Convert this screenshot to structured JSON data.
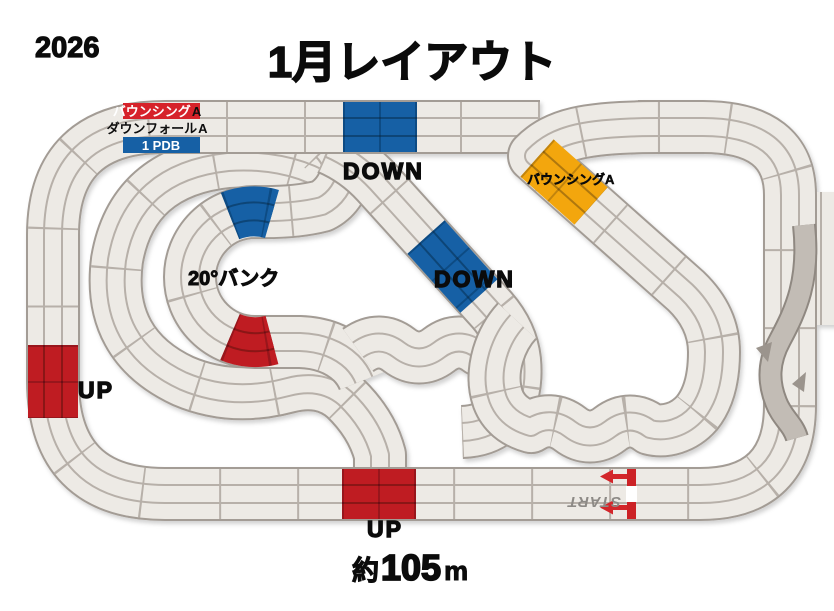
{
  "header": {
    "year": "2026",
    "title": "1月レイアウト"
  },
  "footer": {
    "approx": "約",
    "value": "105",
    "unit": "m"
  },
  "legend": {
    "rows": [
      {
        "label": "バウンシング",
        "suffix": "A",
        "style": "red"
      },
      {
        "label": "ダウンフォール",
        "suffix": "A",
        "style": "plain"
      },
      {
        "label": "1 PDB",
        "suffix": "",
        "style": "blue"
      }
    ]
  },
  "labels": {
    "down_top": "DOWN",
    "down_diagonal": "DOWN",
    "up_left": "UP",
    "up_bottom": "UP",
    "bank": "20°バンク",
    "bouncing_yellow": "バウンシングA",
    "start": "START"
  },
  "colors": {
    "road": "#edeae5",
    "border": "#a39c95",
    "lane_line": "#b7b0a9",
    "slope_blue": "#1460a5",
    "slope_red": "#bf1b21",
    "bouncing_yellow": "#f3a60d",
    "start_bar_red": "#cc2128",
    "arrow_red": "#d3262c",
    "start_text_gray": "#8d8a86",
    "text_black": "#0b0b0b"
  },
  "course": {
    "lanes": 3,
    "sections": [
      {
        "name": "top-straight-down-slope",
        "color": "blue",
        "label": "DOWN"
      },
      {
        "name": "diagonal-down-slope",
        "color": "blue",
        "label": "DOWN"
      },
      {
        "name": "bank-loop-top-slope",
        "color": "blue",
        "label": ""
      },
      {
        "name": "bank-loop-bottom-slope",
        "color": "red",
        "label": ""
      },
      {
        "name": "left-straight-up-slope",
        "color": "red",
        "label": "UP"
      },
      {
        "name": "bottom-straight-up-slope",
        "color": "red",
        "label": "UP"
      },
      {
        "name": "bouncing-a-section",
        "color": "yellow",
        "label": "バウンシングA"
      },
      {
        "name": "start-line",
        "color": "red",
        "label": "START",
        "arrow_direction": "left"
      }
    ]
  }
}
